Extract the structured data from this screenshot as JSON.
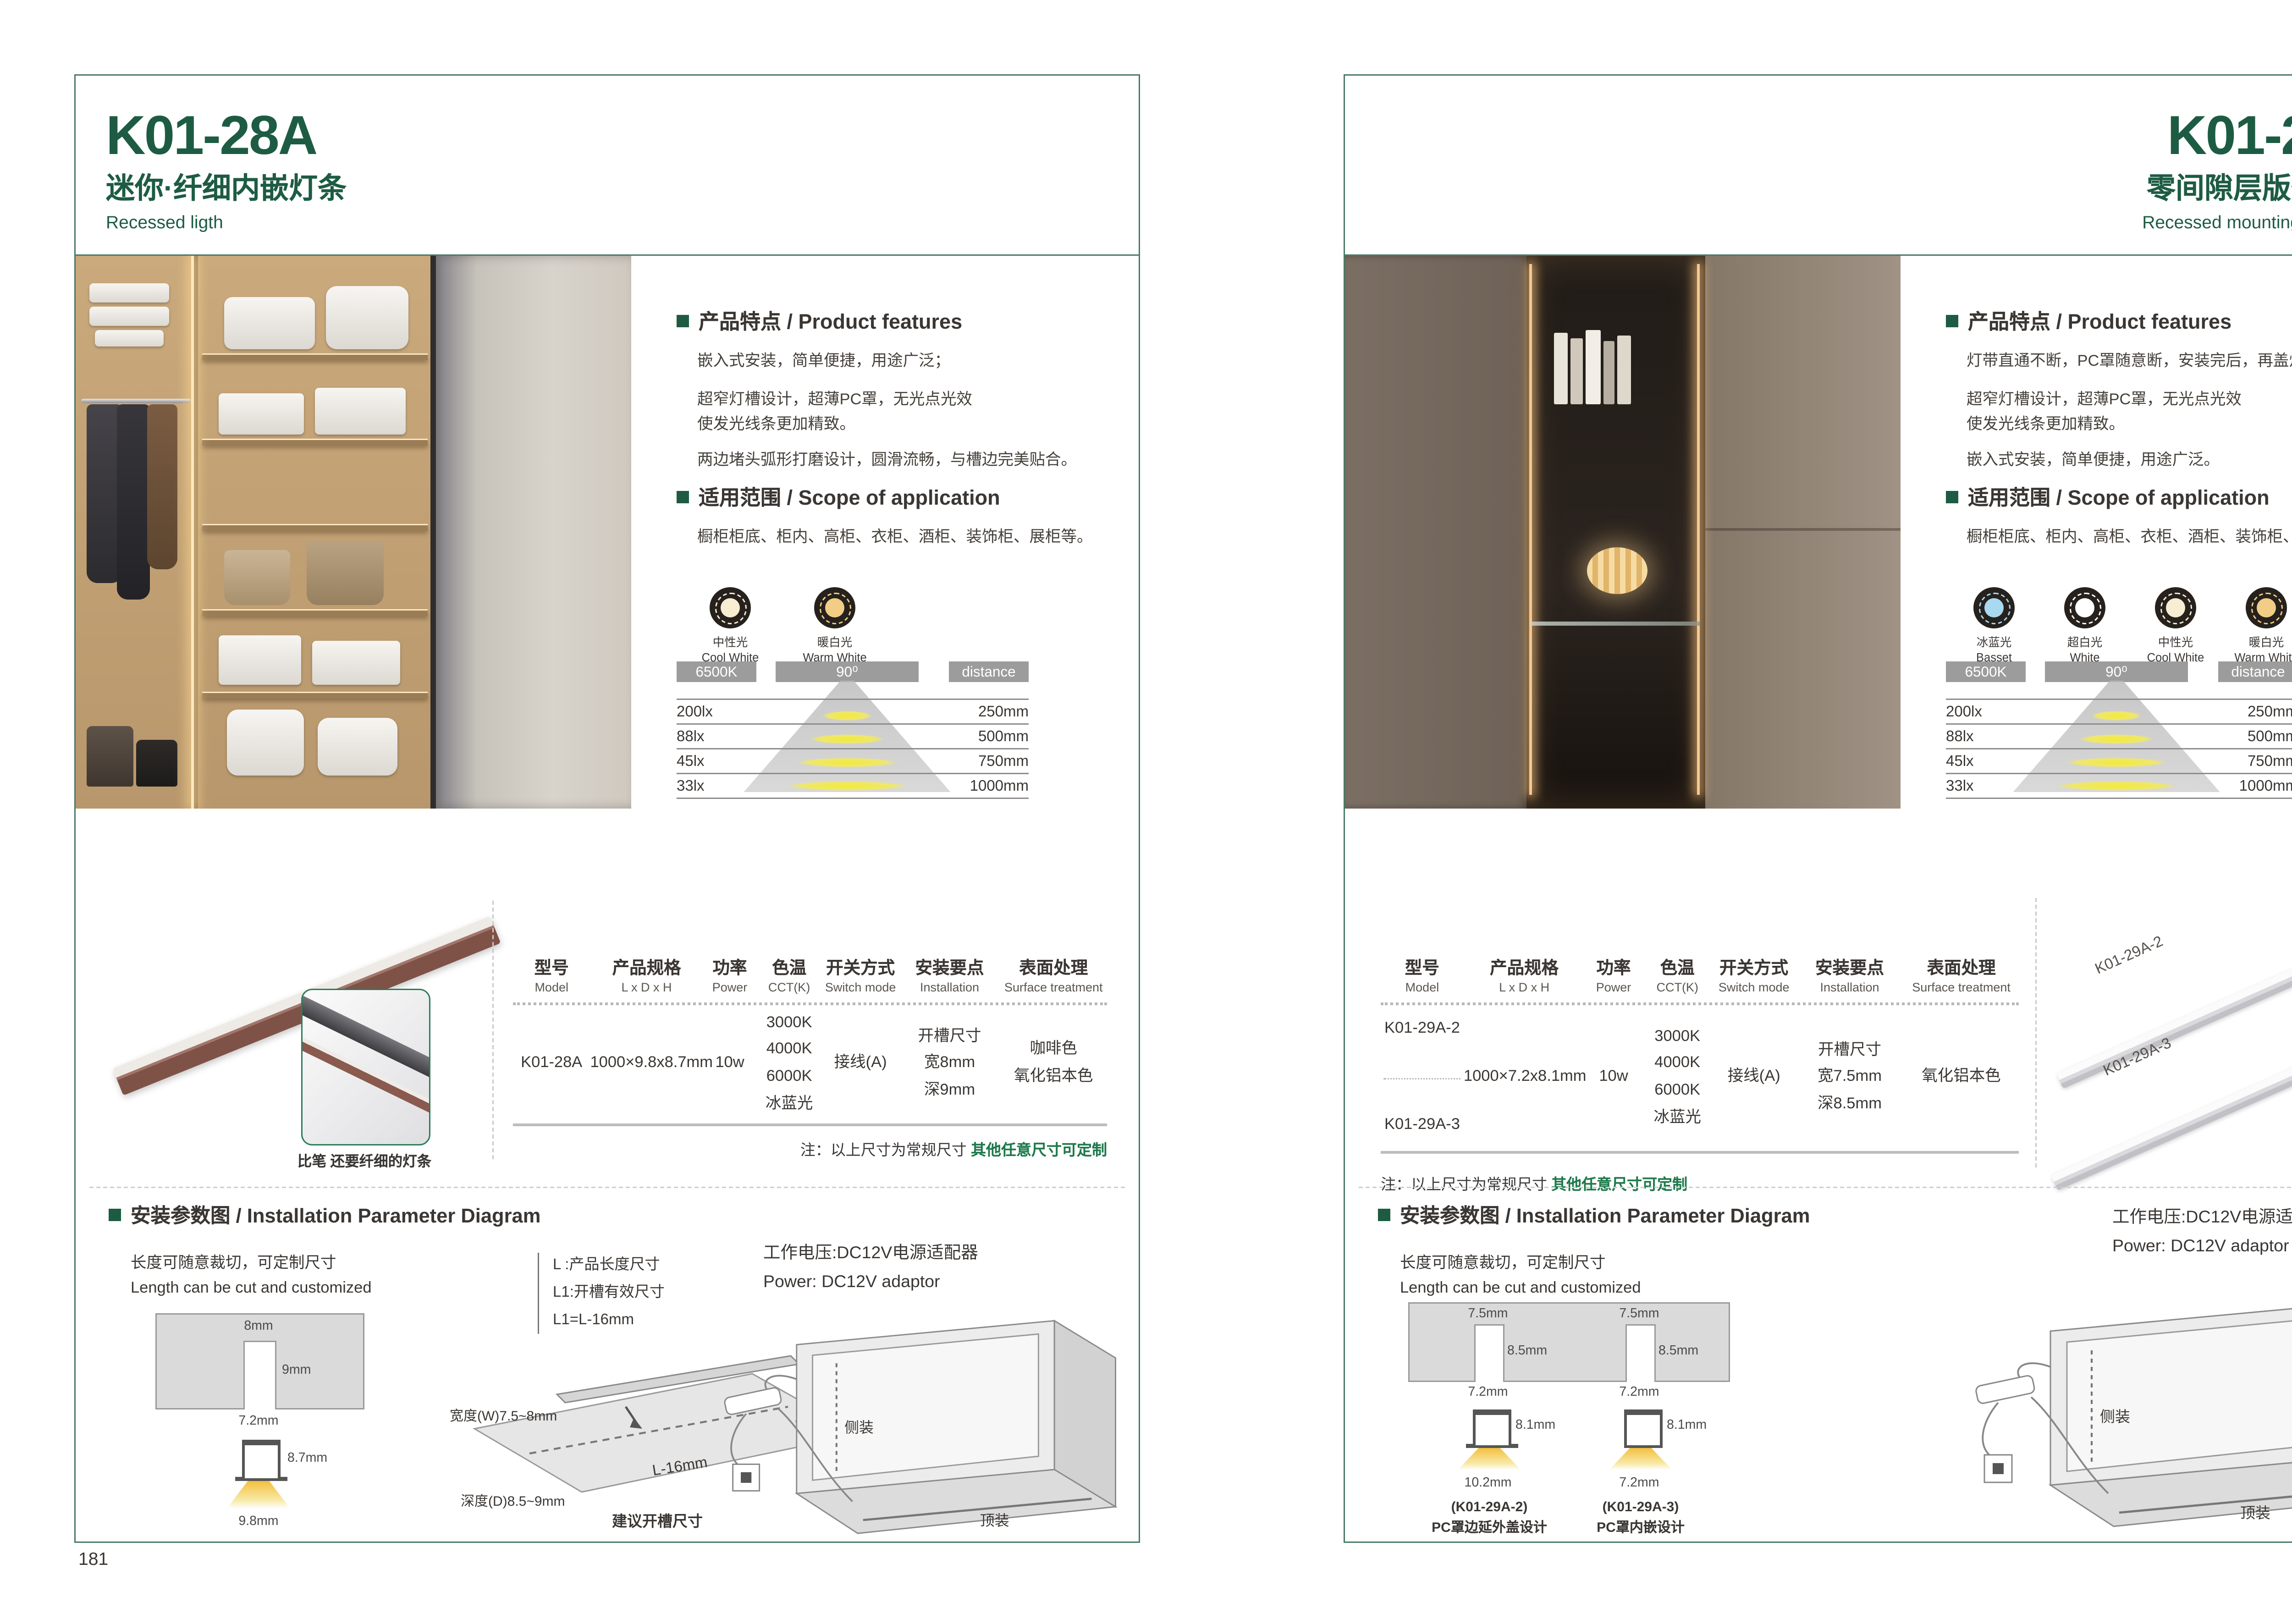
{
  "colors": {
    "accent_green": "#1d5c43",
    "frame_green": "#4a7a64",
    "note_green": "#1f7a4c",
    "chip_gray": "#9c9c9c",
    "profile_brown": "#8a5a4f",
    "cone_yellow": "#f4ea39"
  },
  "pages": [
    {
      "page_number": "181",
      "header": {
        "model": "K01-28A",
        "subtitle_cn": "迷你·纤细内嵌灯条",
        "subtitle_en": "Recessed ligth"
      },
      "features": {
        "title": "产品特点 / Product features",
        "paragraphs": [
          "嵌入式安装，简单便捷，用途广泛；",
          "超窄灯槽设计，超薄PC罩，无光点光效",
          "使发光线条更加精致。",
          "两边堵头弧形打磨设计，圆滑流畅，与槽边完美贴合。"
        ]
      },
      "scope": {
        "title": "适用范围 / Scope of application",
        "text": "橱柜柜底、柜内、高柜、衣柜、酒柜、装饰柜、展柜等。"
      },
      "light_icons": [
        {
          "cn": "中性光",
          "en": "Cool White",
          "color": "#f8ecd2"
        },
        {
          "cn": "暖白光",
          "en": "Warm White",
          "color": "#f2cd86"
        }
      ],
      "light_table": {
        "headers": [
          "6500K",
          "90⁰",
          "distance"
        ],
        "rows": [
          {
            "lux": "200lx",
            "distance": "250mm"
          },
          {
            "lux": "88lx",
            "distance": "500mm"
          },
          {
            "lux": "45lx",
            "distance": "750mm"
          },
          {
            "lux": "33lx",
            "distance": "1000mm"
          }
        ]
      },
      "product_render": {
        "caption": "比笔 还要纤细的灯条"
      },
      "spec_table": {
        "headers": [
          {
            "cn": "型号",
            "en": "Model"
          },
          {
            "cn": "产品规格",
            "en": "L x D x H"
          },
          {
            "cn": "功率",
            "en": "Power"
          },
          {
            "cn": "色温",
            "en": "CCT(K)"
          },
          {
            "cn": "开关方式",
            "en": "Switch mode"
          },
          {
            "cn": "安装要点",
            "en": "Installation"
          },
          {
            "cn": "表面处理",
            "en": "Surface treatment"
          }
        ],
        "row": {
          "model": "K01-28A",
          "size": "1000×9.8x8.7mm",
          "power": "10w",
          "cct": [
            "3000K",
            "4000K",
            "6000K",
            "冰蓝光"
          ],
          "switch": "接线(A)",
          "install": [
            "开槽尺寸",
            "宽8mm",
            "深9mm"
          ],
          "surface": [
            "咖啡色",
            "氧化铝本色"
          ]
        },
        "note_prefix": "注：以上尺寸为常规尺寸 ",
        "note_highlight": "其他任意尺寸可定制"
      },
      "install": {
        "title": "安装参数图 / Installation Parameter Diagram",
        "length_cn": "长度可随意裁切，可定制尺寸",
        "length_en": "Length can be cut and customized",
        "legend": [
          "L :产品长度尺寸",
          "L1:开槽有效尺寸",
          "L1=L-16mm"
        ],
        "cross": {
          "top": "8mm",
          "depth": "9mm",
          "slot": "7.2mm",
          "height": "8.7mm",
          "bottom": "9.8mm"
        },
        "groove": {
          "w": "宽度(W)7.5~8mm",
          "l": "L",
          "l16": "L-16mm",
          "d": "深度(D)8.5~9mm",
          "caption": "建议开槽尺寸"
        },
        "power_cn": "工作电压:DC12V电源适配器",
        "power_en": "Power: DC12V adaptor",
        "cabinet": {
          "side": "侧装",
          "top": "顶装"
        }
      }
    },
    {
      "page_number": "182",
      "header": {
        "model": "K01-29A",
        "subtitle_cn": "零间隙层版条形灯",
        "subtitle_en": "Recessed mounting LED light"
      },
      "features": {
        "title": "产品特点 / Product features",
        "paragraphs": [
          "灯带直通不断，PC罩随意断，安装完后，再盖灯罩；",
          "超窄灯槽设计，超薄PC罩，无光点光效",
          "使发光线条更加精致。",
          "嵌入式安装，简单便捷，用途广泛。"
        ]
      },
      "scope": {
        "title": "适用范围 / Scope of application",
        "text": "橱柜柜底、柜内、高柜、衣柜、酒柜、装饰柜、展柜等。"
      },
      "light_icons": [
        {
          "cn": "冰蓝光",
          "en": "Basset",
          "color": "#a9d9f0"
        },
        {
          "cn": "超白光",
          "en": "White",
          "color": "#ffffff"
        },
        {
          "cn": "中性光",
          "en": "Cool White",
          "color": "#f8ecd2"
        },
        {
          "cn": "暖白光",
          "en": "Warm White",
          "color": "#f2cd86"
        }
      ],
      "light_table": {
        "headers": [
          "6500K",
          "90⁰",
          "distance"
        ],
        "rows": [
          {
            "lux": "200lx",
            "distance": "250mm"
          },
          {
            "lux": "88lx",
            "distance": "500mm"
          },
          {
            "lux": "45lx",
            "distance": "750mm"
          },
          {
            "lux": "33lx",
            "distance": "1000mm"
          }
        ]
      },
      "product_render": {
        "labels": [
          "K01-29A-2",
          "K01-29A-3"
        ]
      },
      "spec_table": {
        "headers": [
          {
            "cn": "型号",
            "en": "Model"
          },
          {
            "cn": "产品规格",
            "en": "L x D x H"
          },
          {
            "cn": "功率",
            "en": "Power"
          },
          {
            "cn": "色温",
            "en": "CCT(K)"
          },
          {
            "cn": "开关方式",
            "en": "Switch mode"
          },
          {
            "cn": "安装要点",
            "en": "Installation"
          },
          {
            "cn": "表面处理",
            "en": "Surface treatment"
          }
        ],
        "row": {
          "models": [
            "K01-29A-2",
            "K01-29A-3"
          ],
          "size": "1000×7.2x8.1mm",
          "power": "10w",
          "cct": [
            "3000K",
            "4000K",
            "6000K",
            "冰蓝光"
          ],
          "switch": "接线(A)",
          "install": [
            "开槽尺寸",
            "宽7.5mm",
            "深8.5mm"
          ],
          "surface": [
            "氧化铝本色"
          ]
        },
        "note_prefix": "注：以上尺寸为常规尺寸 ",
        "note_highlight": "其他任意尺寸可定制"
      },
      "install": {
        "title": "安装参数图 / Installation Parameter Diagram",
        "length_cn": "长度可随意裁切，可定制尺寸",
        "length_en": "Length can be cut and customized",
        "power_cn": "工作电压:DC12V电源适配器",
        "power_en": "Power: DC12V adaptor",
        "sections": [
          {
            "label": "(K01-29A-2)",
            "desc": "PC罩边延外盖设计",
            "top": "7.5mm",
            "depth": "8.5mm",
            "slot": "7.2mm",
            "height": "8.1mm",
            "bottom": "10.2mm"
          },
          {
            "label": "(K01-29A-3)",
            "desc": "PC罩内嵌设计",
            "top": "7.5mm",
            "depth": "8.5mm",
            "slot": "7.2mm",
            "height": "8.1mm",
            "bottom": "7.2mm"
          }
        ],
        "cabinet": {
          "side": "侧装",
          "top": "顶装"
        }
      }
    }
  ]
}
